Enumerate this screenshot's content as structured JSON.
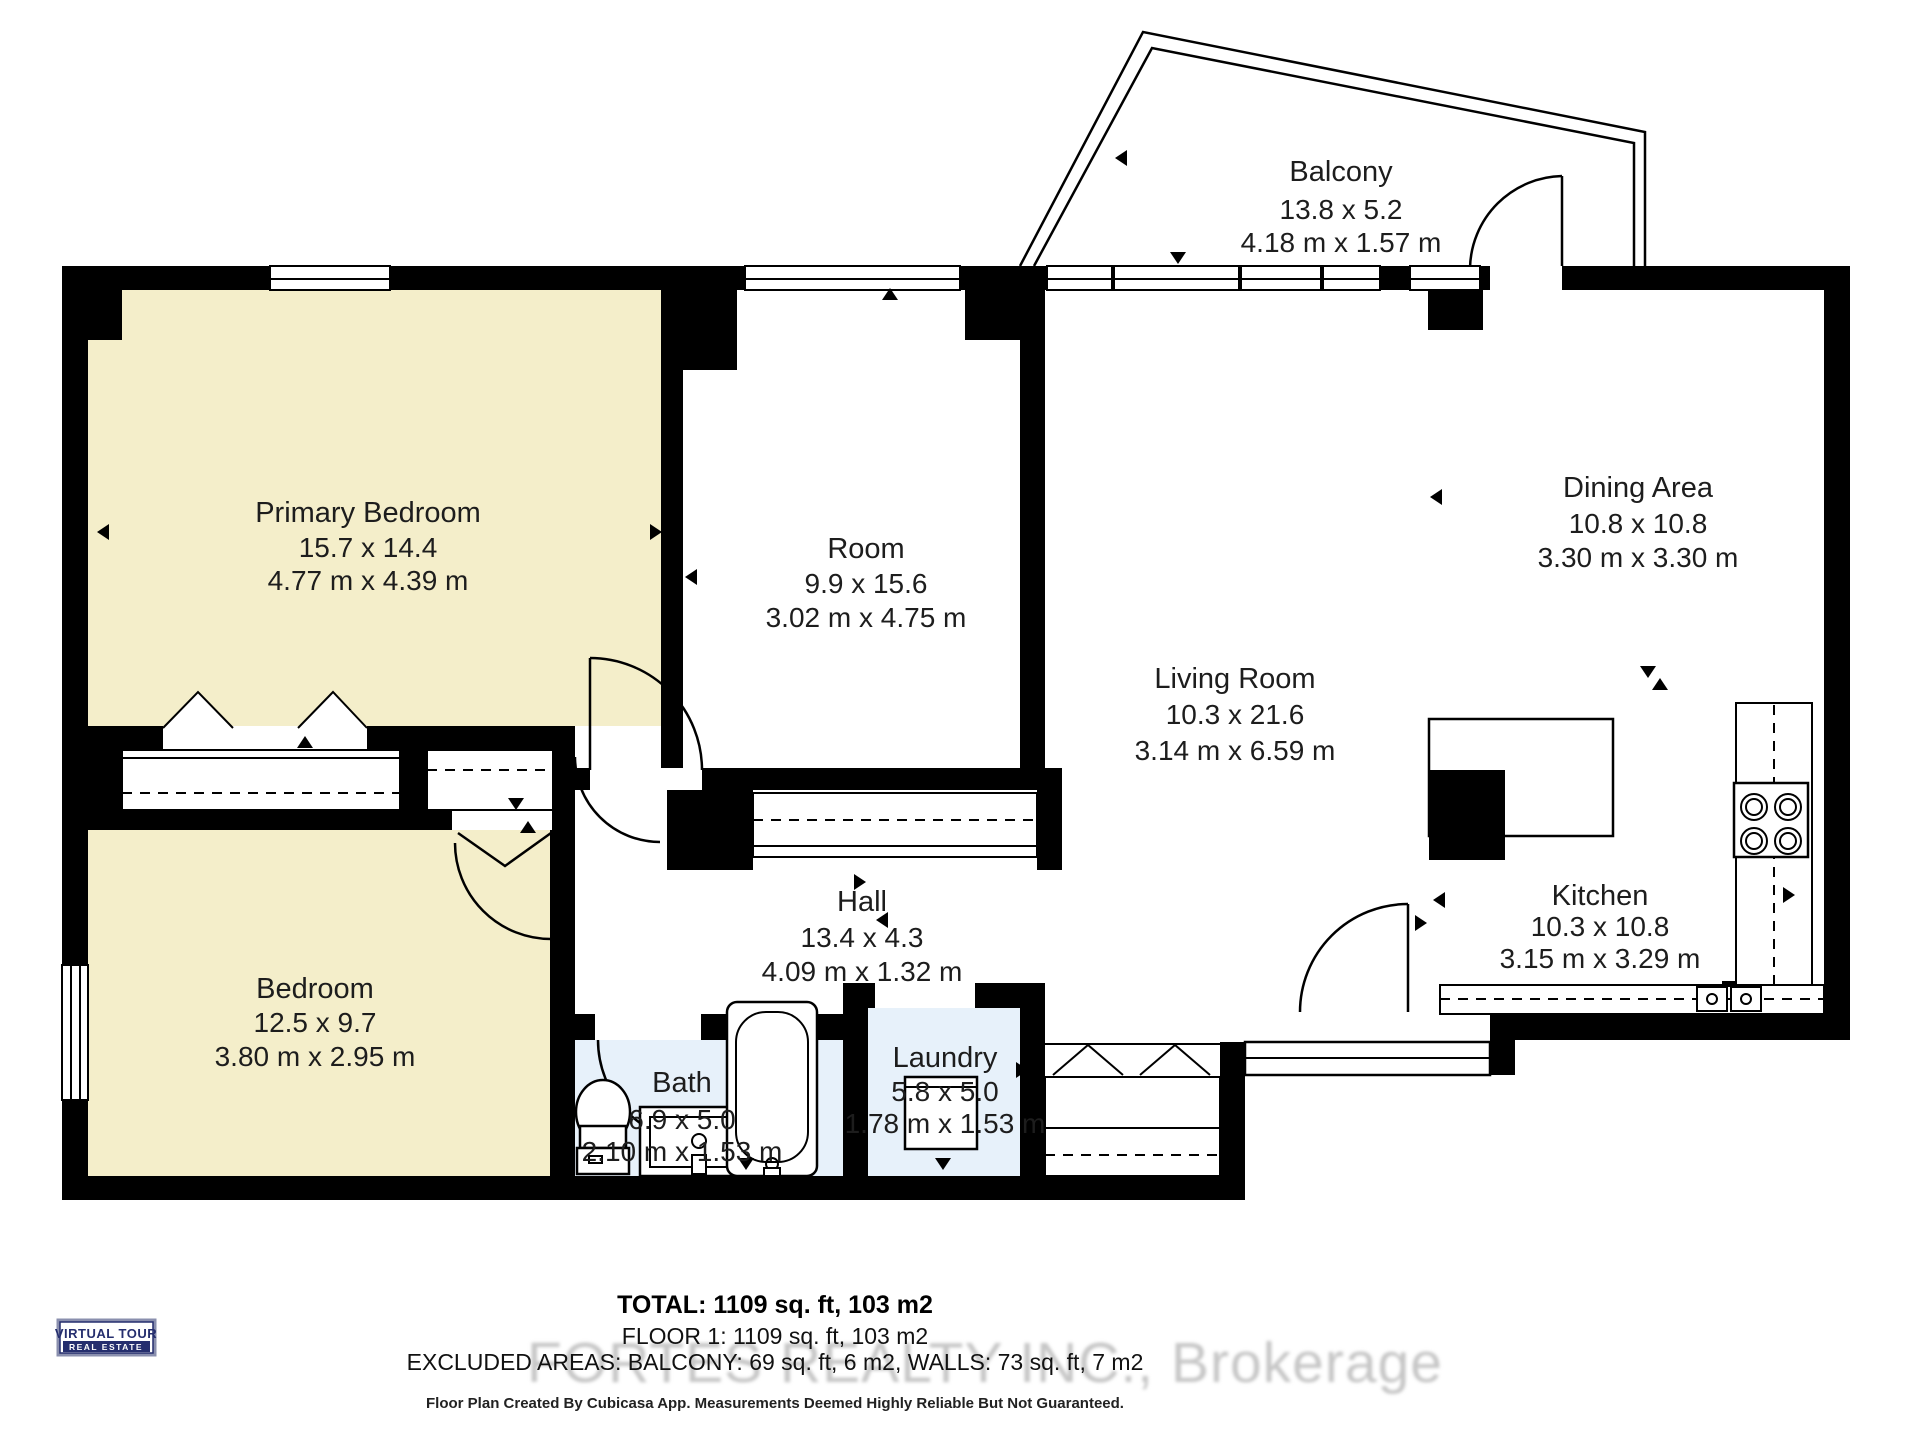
{
  "colors": {
    "wall": "#000000",
    "bedroom_fill": "#f4eeca",
    "wet_fill": "#e7f1fa",
    "text": "#1d1d1d",
    "watermark_gray": "#c6c6c6",
    "logo_navy": "#252e6e"
  },
  "rooms": {
    "balcony": {
      "name": "Balcony",
      "dims_ft": "13.8 x 5.2",
      "dims_m": "4.18 m x 1.57 m"
    },
    "primary": {
      "name": "Primary Bedroom",
      "dims_ft": "15.7 x 14.4",
      "dims_m": "4.77 m x 4.39 m"
    },
    "room": {
      "name": "Room",
      "dims_ft": "9.9 x 15.6",
      "dims_m": "3.02 m x 4.75 m"
    },
    "dining": {
      "name": "Dining Area",
      "dims_ft": "10.8 x 10.8",
      "dims_m": "3.30 m x 3.30 m"
    },
    "living": {
      "name": "Living Room",
      "dims_ft": "10.3 x 21.6",
      "dims_m": "3.14 m x 6.59 m"
    },
    "kitchen": {
      "name": "Kitchen",
      "dims_ft": "10.3 x 10.8",
      "dims_m": "3.15 m x 3.29 m"
    },
    "hall": {
      "name": "Hall",
      "dims_ft": "13.4 x 4.3",
      "dims_m": "4.09 m x 1.32 m"
    },
    "bedroom": {
      "name": "Bedroom",
      "dims_ft": "12.5 x 9.7",
      "dims_m": "3.80 m x 2.95 m"
    },
    "bath": {
      "name": "Bath",
      "dims_ft": "6.9 x 5.0",
      "dims_m": "2.10 m x 1.53 m"
    },
    "laundry": {
      "name": "Laundry",
      "dims_ft": "5.8 x 5.0",
      "dims_m": "1.78 m x 1.53 m"
    }
  },
  "footer": {
    "total": "TOTAL: 1109 sq. ft, 103 m2",
    "floor": "FLOOR 1: 1109 sq. ft, 103 m2",
    "excluded": "EXCLUDED AREAS: BALCONY: 69 sq. ft, 6 m2, WALLS: 73 sq. ft, 7 m2",
    "disclaimer": "Floor Plan Created By Cubicasa App. Measurements Deemed Highly Reliable But Not Guaranteed."
  },
  "watermark": "FORTES REALTY INC., Brokerage",
  "logo": {
    "line1": "VIRTUAL TOUR",
    "line2": "REAL ESTATE"
  }
}
